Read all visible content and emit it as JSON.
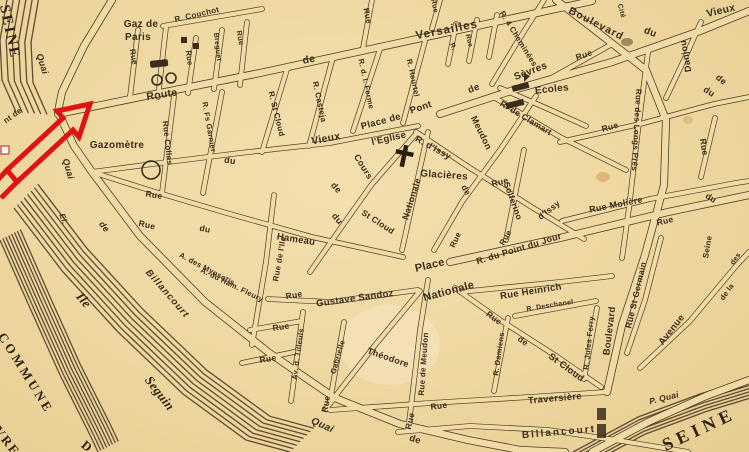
{
  "map": {
    "type": "vintage-street-map",
    "colors": {
      "parchment": "#eed7a0",
      "ink": "#3b2d1b",
      "river_ink": "#52402a",
      "annotation_red": "#e01313"
    },
    "icons": {
      "red-arrow-icon": "bent-outline-arrow",
      "gasworks-icon": "bar-and-two-circles",
      "gazometer-icon": "circle",
      "church-cross-icon": "cross",
      "school-icon": "black-bars-with-flag",
      "building-icon": "black-square",
      "selection-handle-icon": "white-square"
    },
    "labels": [
      {
        "id": "seine-nw",
        "text": "SEINE",
        "x": 9,
        "y": 32,
        "r": 78,
        "s": 15,
        "f": 1,
        "ls": 2
      },
      {
        "id": "seine-se",
        "text": "SEINE",
        "x": 699,
        "y": 429,
        "r": -25,
        "s": 18,
        "f": 1,
        "ls": 5
      },
      {
        "id": "commune",
        "text": "COMMUNE",
        "x": 26,
        "y": 373,
        "r": 58,
        "s": 13,
        "f": 1,
        "ls": 3
      },
      {
        "id": "commune-sevres",
        "text": "SÈVRES",
        "x": 4,
        "y": 437,
        "r": 52,
        "s": 13,
        "f": 1,
        "ls": 2
      },
      {
        "id": "commune-de",
        "text": "D",
        "x": 87,
        "y": 446,
        "r": 40,
        "s": 13,
        "f": 1
      },
      {
        "id": "ile",
        "text": "Ile",
        "x": 84,
        "y": 300,
        "r": 50,
        "s": 13,
        "f": 1,
        "i": 1
      },
      {
        "id": "seguin",
        "text": "Seguin",
        "x": 160,
        "y": 393,
        "r": 52,
        "s": 13,
        "f": 1,
        "i": 1
      },
      {
        "id": "quai-nw",
        "text": "Quai",
        "x": 42,
        "y": 64,
        "r": 73,
        "s": 9,
        "i": 1
      },
      {
        "id": "quai-w",
        "text": "Quai",
        "x": 68,
        "y": 169,
        "r": 74,
        "s": 9,
        "i": 1
      },
      {
        "id": "quai-de",
        "text": "de",
        "x": 104,
        "y": 227,
        "r": 52,
        "s": 9,
        "i": 1
      },
      {
        "id": "quai-billancourt",
        "text": "Billancourt",
        "x": 167,
        "y": 294,
        "r": 49,
        "s": 9.5,
        "i": 1,
        "ls": 1
      },
      {
        "id": "el-frag",
        "text": "El.",
        "x": 63,
        "y": 219,
        "r": 70,
        "s": 8,
        "i": 1
      },
      {
        "id": "pont-frag",
        "text": "nt de",
        "x": 13,
        "y": 116,
        "r": -36,
        "s": 8
      },
      {
        "id": "gaz-de-paris-1",
        "text": "Gaz de",
        "x": 141,
        "y": 25,
        "r": 0,
        "s": 10
      },
      {
        "id": "gaz-de-paris-2",
        "text": "Paris",
        "x": 138,
        "y": 38,
        "r": 0,
        "s": 10
      },
      {
        "id": "r-couchot",
        "text": "R. Couchot",
        "x": 197,
        "y": 15,
        "r": -13,
        "s": 8
      },
      {
        "id": "rue-v1",
        "text": "Rue",
        "x": 133,
        "y": 57,
        "r": 80,
        "s": 8
      },
      {
        "id": "rue-v2",
        "text": "Rue",
        "x": 189,
        "y": 58,
        "r": 82,
        "s": 7.5
      },
      {
        "id": "breguet",
        "text": "Breguet",
        "x": 217,
        "y": 47,
        "r": 84,
        "s": 7
      },
      {
        "id": "rue-v3",
        "text": "Rue",
        "x": 240,
        "y": 38,
        "r": 80,
        "s": 7.5
      },
      {
        "id": "route",
        "text": "Route",
        "x": 162,
        "y": 95,
        "r": -9,
        "s": 10.5
      },
      {
        "id": "rue-collas",
        "text": "Rue Collas",
        "x": 167,
        "y": 143,
        "r": 84,
        "s": 8
      },
      {
        "id": "garnier",
        "text": "R. Fs Garnier",
        "x": 209,
        "y": 127,
        "r": 80,
        "s": 7.5
      },
      {
        "id": "gazometre",
        "text": "Gazomètre",
        "x": 117,
        "y": 146,
        "r": 0,
        "s": 10
      },
      {
        "id": "route-de",
        "text": "de",
        "x": 309,
        "y": 60,
        "r": -11,
        "s": 10.5
      },
      {
        "id": "versailles",
        "text": "Versailles",
        "x": 447,
        "y": 31,
        "r": -11,
        "s": 11.5,
        "ls": 1
      },
      {
        "id": "rue-v4",
        "text": "Rue",
        "x": 367,
        "y": 16,
        "r": 78,
        "s": 8
      },
      {
        "id": "rue-v5",
        "text": "Rue",
        "x": 434,
        "y": 6,
        "r": 78,
        "s": 7
      },
      {
        "id": "stcloud-n",
        "text": "R. St Cloud",
        "x": 276,
        "y": 114,
        "r": 76,
        "s": 8
      },
      {
        "id": "casteja",
        "text": "R. Casteja",
        "x": 319,
        "y": 102,
        "r": 78,
        "s": 8
      },
      {
        "id": "ferme",
        "text": "R. d. l. Ferme",
        "x": 366,
        "y": 84,
        "r": 78,
        "s": 7.5
      },
      {
        "id": "heurtel",
        "text": "R. Heurtel",
        "x": 413,
        "y": 78,
        "r": 78,
        "s": 7.5
      },
      {
        "id": "vieux-w",
        "text": "Vieux",
        "x": 326,
        "y": 139,
        "r": -11,
        "s": 10.5
      },
      {
        "id": "du-w",
        "text": "du",
        "x": 230,
        "y": 161,
        "r": 8,
        "s": 9
      },
      {
        "id": "rue-small-a",
        "text": "Rue",
        "x": 154,
        "y": 195,
        "r": 9,
        "s": 8.5
      },
      {
        "id": "cours",
        "text": "Cours",
        "x": 363,
        "y": 167,
        "r": 58,
        "s": 9
      },
      {
        "id": "de-frag1",
        "text": "de",
        "x": 336,
        "y": 188,
        "r": 48,
        "s": 9
      },
      {
        "id": "du-frag1",
        "text": "du",
        "x": 337,
        "y": 219,
        "r": 50,
        "s": 9
      },
      {
        "id": "stcloud-mid",
        "text": "St Cloud",
        "x": 378,
        "y": 222,
        "r": 33,
        "s": 8.5
      },
      {
        "id": "place-de",
        "text": "Place de",
        "x": 381,
        "y": 122,
        "r": -15,
        "s": 9.5
      },
      {
        "id": "pont",
        "text": "Pont",
        "x": 421,
        "y": 108,
        "r": -19,
        "s": 9.5
      },
      {
        "id": "eglise",
        "text": "l'Eglise",
        "x": 389,
        "y": 139,
        "r": -13,
        "s": 9.5
      },
      {
        "id": "dissy",
        "text": "R. d'Issy",
        "x": 433,
        "y": 148,
        "r": 29,
        "s": 9
      },
      {
        "id": "glacieres",
        "text": "Glacières",
        "x": 444,
        "y": 176,
        "r": 4,
        "s": 10
      },
      {
        "id": "nationale-st",
        "text": "Nationale",
        "x": 412,
        "y": 199,
        "r": -72,
        "s": 9
      },
      {
        "id": "meudon-up",
        "text": "Meudon",
        "x": 481,
        "y": 133,
        "r": 64,
        "s": 9
      },
      {
        "id": "de-meudon",
        "text": "de",
        "x": 466,
        "y": 190,
        "r": 60,
        "s": 8.5
      },
      {
        "id": "rue-sol",
        "text": "Rue",
        "x": 500,
        "y": 182,
        "r": -14,
        "s": 8.5
      },
      {
        "id": "solferino",
        "text": "Solferino",
        "x": 513,
        "y": 201,
        "r": 70,
        "s": 8.5
      },
      {
        "id": "dissy2",
        "text": "d'Issy",
        "x": 549,
        "y": 210,
        "r": -38,
        "s": 8.5
      },
      {
        "id": "clamart",
        "text": "R. de Clamart",
        "x": 526,
        "y": 118,
        "r": 31,
        "s": 8.5
      },
      {
        "id": "cheminees",
        "text": "R. 4 Cheminées",
        "x": 518,
        "y": 39,
        "r": 58,
        "s": 8
      },
      {
        "id": "sevres-st",
        "text": "Sèvres",
        "x": 531,
        "y": 72,
        "r": -21,
        "s": 10
      },
      {
        "id": "ecoles",
        "text": "Ecoles",
        "x": 552,
        "y": 90,
        "r": -6,
        "s": 10
      },
      {
        "id": "r-tiny1",
        "text": "R.",
        "x": 452,
        "y": 47,
        "r": 70,
        "s": 6.5
      },
      {
        "id": "r-tiny2",
        "text": "Rue",
        "x": 468,
        "y": 41,
        "r": 75,
        "s": 6.5
      },
      {
        "id": "de-vps",
        "text": "de",
        "x": 474,
        "y": 89,
        "r": -22,
        "s": 9.5
      },
      {
        "id": "bd-top",
        "text": "Boulevard",
        "x": 596,
        "y": 24,
        "r": 27,
        "s": 10.5,
        "ls": 1
      },
      {
        "id": "bd-du",
        "text": "du",
        "x": 650,
        "y": 33,
        "r": 22,
        "s": 10
      },
      {
        "id": "cite",
        "text": "Cité",
        "x": 621,
        "y": 11,
        "r": 76,
        "s": 7
      },
      {
        "id": "vieux-ne",
        "text": "Vieux",
        "x": 721,
        "y": 11,
        "r": -13,
        "s": 10.5
      },
      {
        "id": "danjou",
        "text": "Danjou",
        "x": 686,
        "y": 56,
        "r": -100,
        "s": 9
      },
      {
        "id": "de-ne",
        "text": "de",
        "x": 721,
        "y": 80,
        "r": 38,
        "s": 9
      },
      {
        "id": "du-ne",
        "text": "du",
        "x": 709,
        "y": 92,
        "r": 33,
        "s": 9
      },
      {
        "id": "rue-ne2",
        "text": "Rue",
        "x": 584,
        "y": 55,
        "r": -19,
        "s": 8.5
      },
      {
        "id": "rue-ne",
        "text": "Rue",
        "x": 610,
        "y": 127,
        "r": -16,
        "s": 8.5
      },
      {
        "id": "longs-pres",
        "text": "Rue des Longs Prés",
        "x": 636,
        "y": 130,
        "r": 93,
        "s": 8
      },
      {
        "id": "moliere",
        "text": "Rue Molière",
        "x": 616,
        "y": 205,
        "r": -11,
        "s": 9
      },
      {
        "id": "rue-e-v",
        "text": "Rue",
        "x": 704,
        "y": 147,
        "r": 80,
        "s": 8.5
      },
      {
        "id": "du-e",
        "text": "du",
        "x": 711,
        "y": 198,
        "r": 32,
        "s": 8.5
      },
      {
        "id": "rue-e2",
        "text": "Rue",
        "x": 665,
        "y": 221,
        "r": -13,
        "s": 8.5
      },
      {
        "id": "pdj",
        "text": "R. du Point du Jour",
        "x": 519,
        "y": 249,
        "r": -17,
        "s": 9
      },
      {
        "id": "rue-pn1",
        "text": "Rue",
        "x": 456,
        "y": 240,
        "r": -65,
        "s": 8
      },
      {
        "id": "rue-pn2",
        "text": "Rue",
        "x": 506,
        "y": 238,
        "r": -60,
        "s": 8
      },
      {
        "id": "place-n",
        "text": "Place",
        "x": 430,
        "y": 266,
        "r": -13,
        "s": 11
      },
      {
        "id": "nationale-pl",
        "text": "Nationale",
        "x": 449,
        "y": 292,
        "r": -15,
        "s": 11
      },
      {
        "id": "heinrich",
        "text": "Rue Heinrich",
        "x": 531,
        "y": 292,
        "r": -9,
        "s": 9.5
      },
      {
        "id": "deschanel",
        "text": "R. Deschanel",
        "x": 550,
        "y": 306,
        "r": -9,
        "s": 7
      },
      {
        "id": "rue-gs",
        "text": "Rue",
        "x": 294,
        "y": 295,
        "r": -10,
        "s": 8.5
      },
      {
        "id": "sandoz",
        "text": "Gustave Sandoz",
        "x": 355,
        "y": 299,
        "r": -8,
        "s": 9.5
      },
      {
        "id": "hameau-rue",
        "text": "Rue",
        "x": 147,
        "y": 225,
        "r": 13,
        "s": 8.5
      },
      {
        "id": "hameau-du",
        "text": "du",
        "x": 205,
        "y": 229,
        "r": 11,
        "s": 8.5
      },
      {
        "id": "hameau",
        "text": "Hameau",
        "x": 296,
        "y": 240,
        "r": 9,
        "s": 9.5
      },
      {
        "id": "myosotis",
        "text": "A. des Myosotis",
        "x": 207,
        "y": 269,
        "r": 28,
        "s": 7.5
      },
      {
        "id": "ham-fleury",
        "text": "A. du Ham. Fleury",
        "x": 232,
        "y": 285,
        "r": 26,
        "s": 7.5
      },
      {
        "id": "rue-ile",
        "text": "Rue de l'Ile",
        "x": 280,
        "y": 259,
        "r": -80,
        "s": 8
      },
      {
        "id": "rue-b1",
        "text": "Rue",
        "x": 281,
        "y": 327,
        "r": -9,
        "s": 8.5
      },
      {
        "id": "rue-b2",
        "text": "Rue",
        "x": 268,
        "y": 359,
        "r": -9,
        "s": 8.5
      },
      {
        "id": "tilleuls",
        "text": "Av. d. Tilleuls",
        "x": 298,
        "y": 354,
        "r": -82,
        "s": 7.5
      },
      {
        "id": "gabrielle",
        "text": "Gabrielle",
        "x": 338,
        "y": 357,
        "r": -74,
        "s": 7.5
      },
      {
        "id": "theodore",
        "text": "Théodore",
        "x": 388,
        "y": 358,
        "r": 19,
        "s": 9
      },
      {
        "id": "rue-b3",
        "text": "Rue",
        "x": 326,
        "y": 404,
        "r": -80,
        "s": 8.5
      },
      {
        "id": "quai-s",
        "text": "Quai",
        "x": 322,
        "y": 426,
        "r": 24,
        "s": 10,
        "i": 1
      },
      {
        "id": "rue-bill-v",
        "text": "Rue",
        "x": 410,
        "y": 421,
        "r": -77,
        "s": 8.5
      },
      {
        "id": "de-bill",
        "text": "de",
        "x": 415,
        "y": 440,
        "r": 18,
        "s": 9.5
      },
      {
        "id": "billancourt-s",
        "text": "Billancourt",
        "x": 559,
        "y": 433,
        "r": -5,
        "s": 10,
        "ls": 2
      },
      {
        "id": "traversiere",
        "text": "Traversière",
        "x": 555,
        "y": 399,
        "r": -5,
        "s": 9.5
      },
      {
        "id": "rue-trav",
        "text": "Rue",
        "x": 439,
        "y": 406,
        "r": -7,
        "s": 8.5
      },
      {
        "id": "meudon-s",
        "text": "Rue de Meudon",
        "x": 424,
        "y": 364,
        "r": -86,
        "s": 8
      },
      {
        "id": "damiens",
        "text": "R. Damiens",
        "x": 499,
        "y": 354,
        "r": -82,
        "s": 7.5
      },
      {
        "id": "rue-sc",
        "text": "Rue",
        "x": 494,
        "y": 318,
        "r": 36,
        "s": 8.5
      },
      {
        "id": "de-sc",
        "text": "de",
        "x": 523,
        "y": 341,
        "r": 36,
        "s": 8.5
      },
      {
        "id": "stcloud-s",
        "text": "St Cloud",
        "x": 566,
        "y": 368,
        "r": 36,
        "s": 9.5
      },
      {
        "id": "ferry",
        "text": "R. Jules Ferry",
        "x": 589,
        "y": 343,
        "r": -84,
        "s": 7.5
      },
      {
        "id": "bd-s",
        "text": "Boulevard",
        "x": 610,
        "y": 331,
        "r": -83,
        "s": 9.5
      },
      {
        "id": "st-germain",
        "text": "Rue St Germain",
        "x": 636,
        "y": 295,
        "r": -77,
        "s": 8.5
      },
      {
        "id": "avenue",
        "text": "Avenue",
        "x": 672,
        "y": 330,
        "r": -52,
        "s": 9.5
      },
      {
        "id": "de-la",
        "text": "de la",
        "x": 727,
        "y": 292,
        "r": -55,
        "s": 7.5
      },
      {
        "id": "seine-av",
        "text": "Seine",
        "x": 708,
        "y": 247,
        "r": -80,
        "s": 8
      },
      {
        "id": "des-frag",
        "text": "des",
        "x": 736,
        "y": 259,
        "r": -55,
        "s": 7
      },
      {
        "id": "p-quai",
        "text": "P. Quai",
        "x": 664,
        "y": 398,
        "r": -14,
        "s": 8.5,
        "i": 1
      }
    ]
  }
}
